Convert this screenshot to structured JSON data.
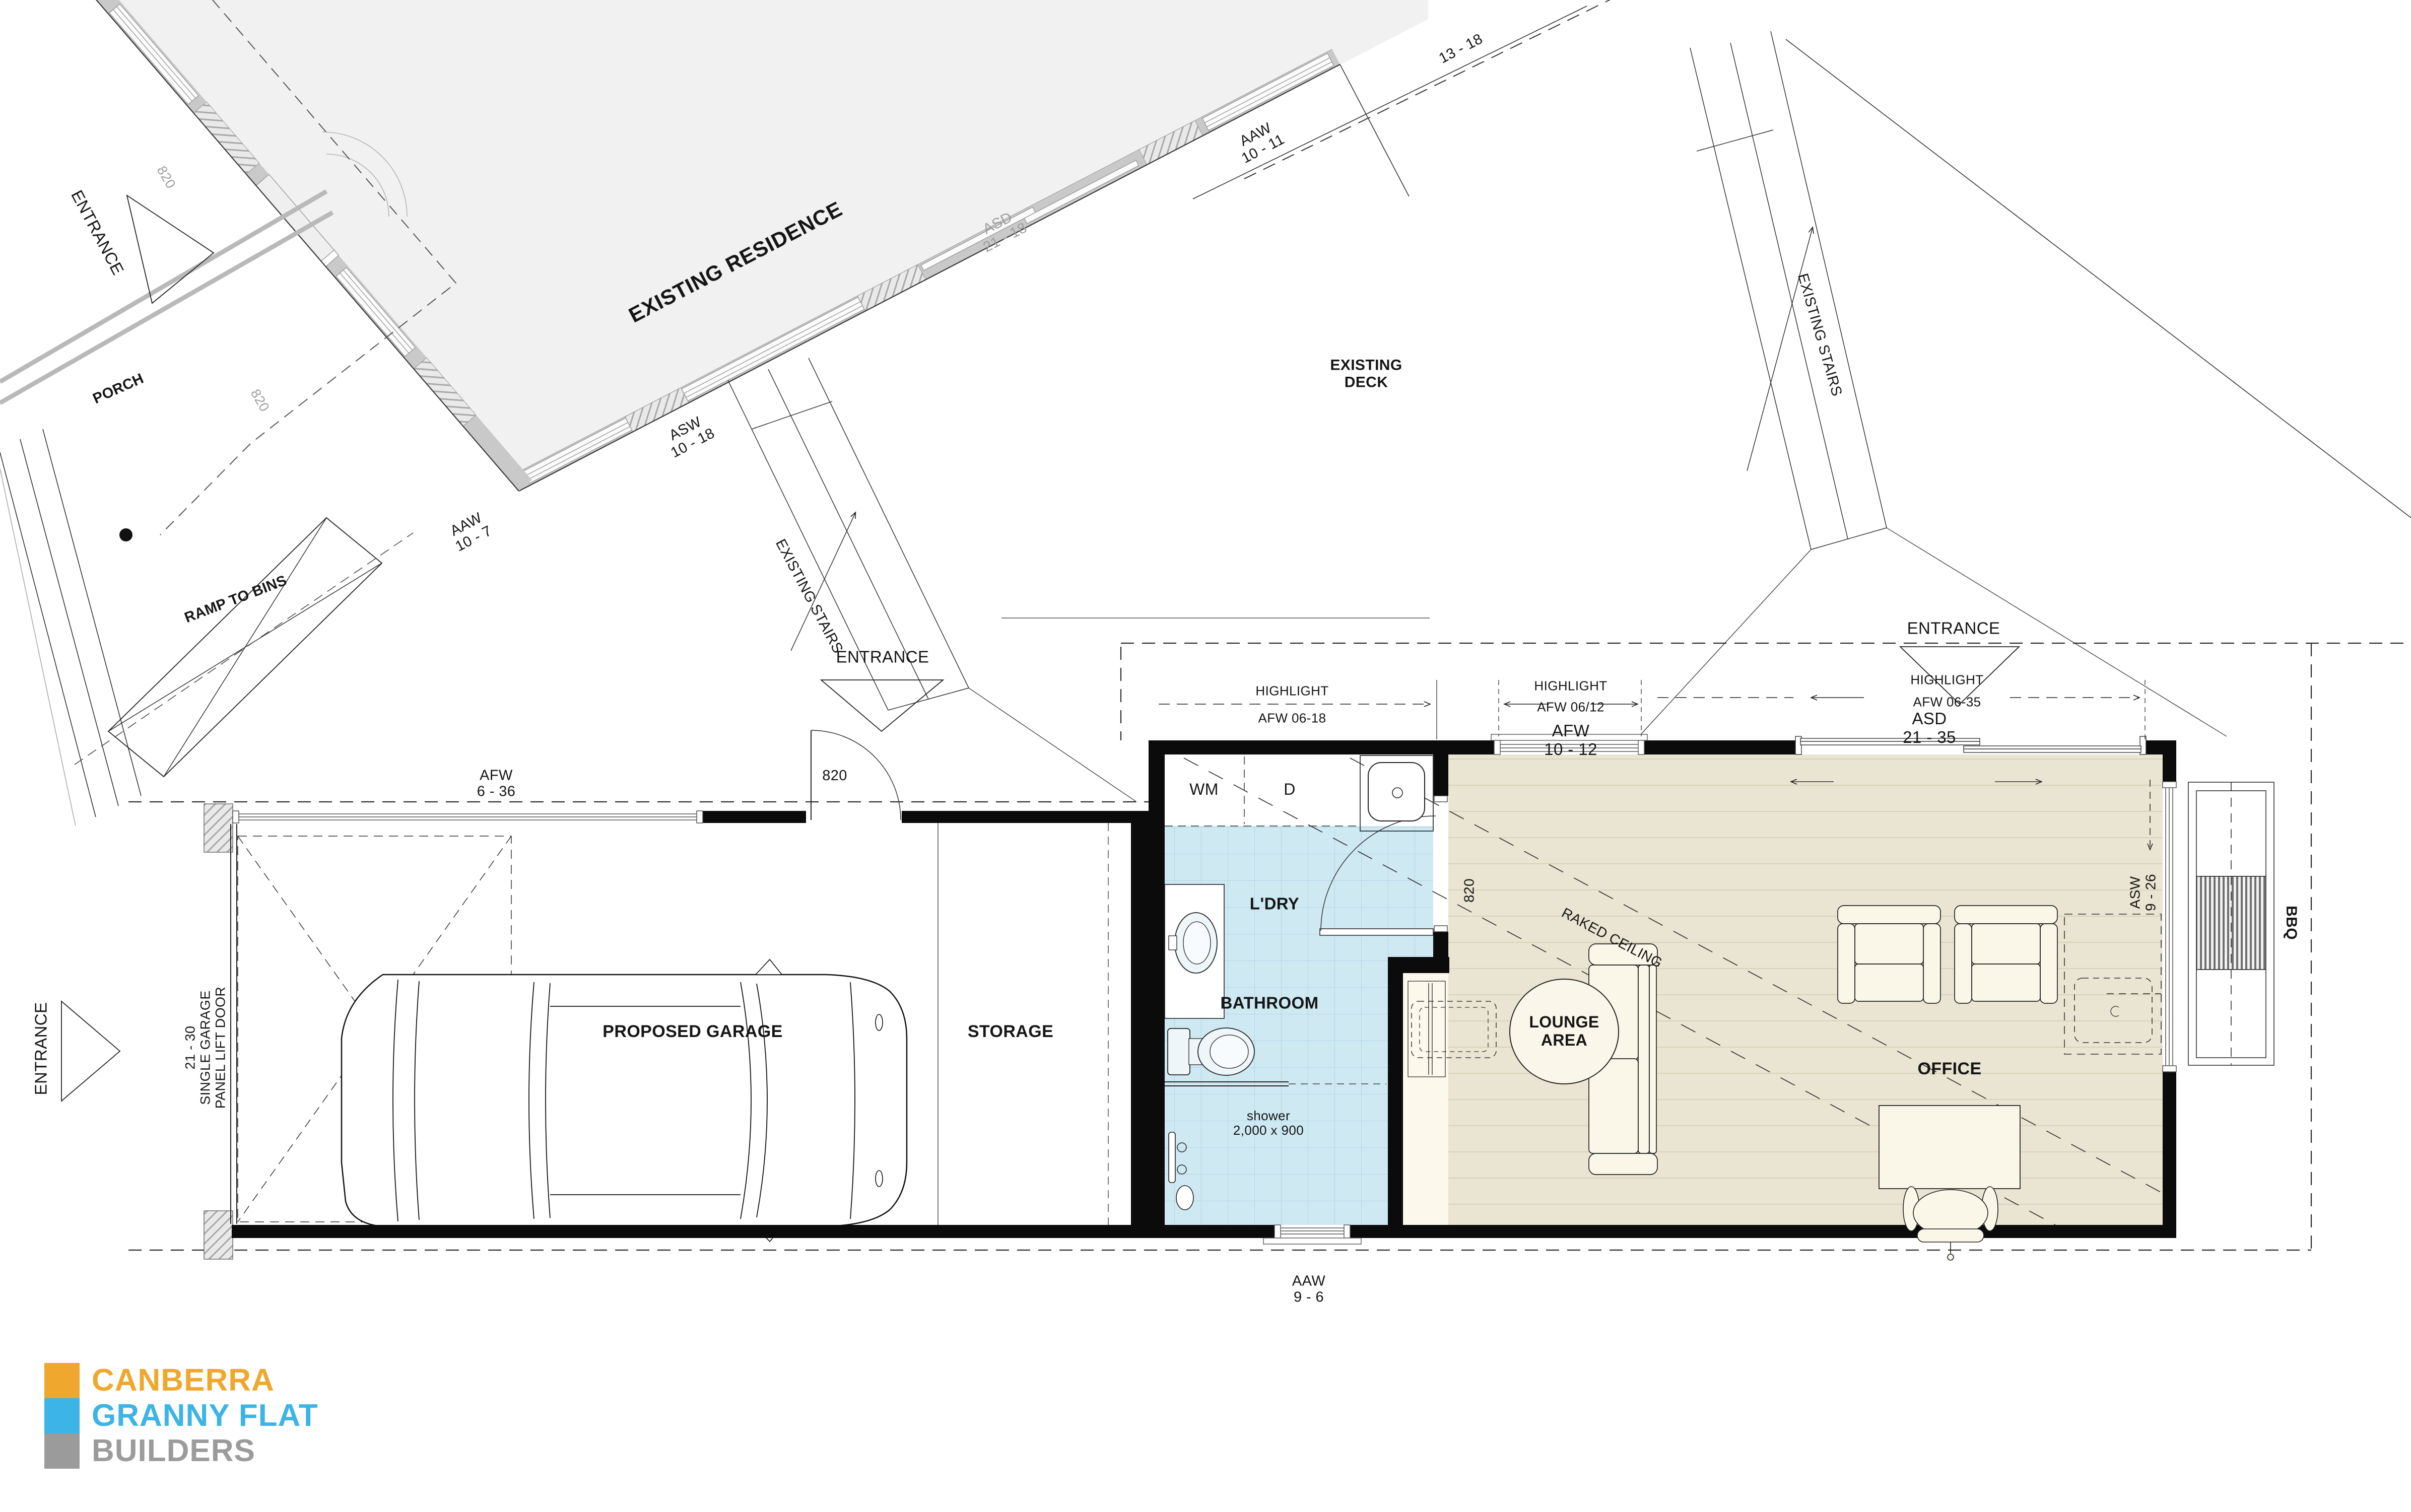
{
  "logo": {
    "canberra": "CANBERRA",
    "granny_flat": "GRANNY FLAT",
    "builders": "BUILDERS",
    "orange": "#EFA72E",
    "blue": "#3CB4E5",
    "gray": "#9B9B9B"
  },
  "site": {
    "residence": {
      "name": "EXISTING RESIDENCE",
      "porch": "PORCH",
      "entrance": "ENTRANCE",
      "ramp": "RAMP TO BINS",
      "door_a": "820",
      "door_b": "820",
      "win_aaw_10_7": [
        "AAW",
        "10 - 7"
      ],
      "win_asw_10_18": [
        "ASW",
        "10 - 18"
      ],
      "win_asd_21_18": [
        "ASD",
        "21 - 18"
      ],
      "win_aaw_10_11": [
        "AAW",
        "10 - 11"
      ],
      "dim_13_18": "13 - 18"
    },
    "deck": {
      "name": [
        "EXISTING",
        "DECK"
      ],
      "stairs_left": "EXISTING STAIRS",
      "stairs_right": "EXISTING STAIRS",
      "entrance_mid": "ENTRANCE",
      "entrance_right": "ENTRANCE"
    }
  },
  "flat": {
    "garage": {
      "name": "PROPOSED GARAGE",
      "storage": "STORAGE",
      "door_label": "820",
      "win_afw_6_36": [
        "AFW",
        "6 - 36"
      ],
      "side_entrance": "ENTRANCE",
      "garage_door": [
        "21 - 30",
        "SINGLE GARAGE",
        "PANEL LIFT DOOR"
      ]
    },
    "laundry": {
      "wm": "WM",
      "dryer": "D",
      "name": "L'DRY",
      "door_label": "820"
    },
    "bathroom": {
      "name": "BATHROOM",
      "shower": [
        "shower",
        "2,000 x 900"
      ],
      "win_aaw_9_6": [
        "AAW",
        "9 - 6"
      ]
    },
    "living": {
      "lounge": [
        "LOUNGE",
        "AREA"
      ],
      "office": "OFFICE",
      "raked": "RAKED CEILING",
      "win_asw_9_26": [
        "ASW",
        "9 - 26"
      ],
      "bbq": "BBQ"
    },
    "dims": {
      "hl1": [
        "HIGHLIGHT",
        "AFW 06-18"
      ],
      "hl2": [
        "HIGHLIGHT",
        "AFW 06/12"
      ],
      "win2": [
        "AFW",
        "10 - 12"
      ],
      "hl3": [
        "HIGHLIGHT",
        "AFW 06-35"
      ],
      "win3": [
        "ASD",
        "21 - 35"
      ]
    }
  }
}
